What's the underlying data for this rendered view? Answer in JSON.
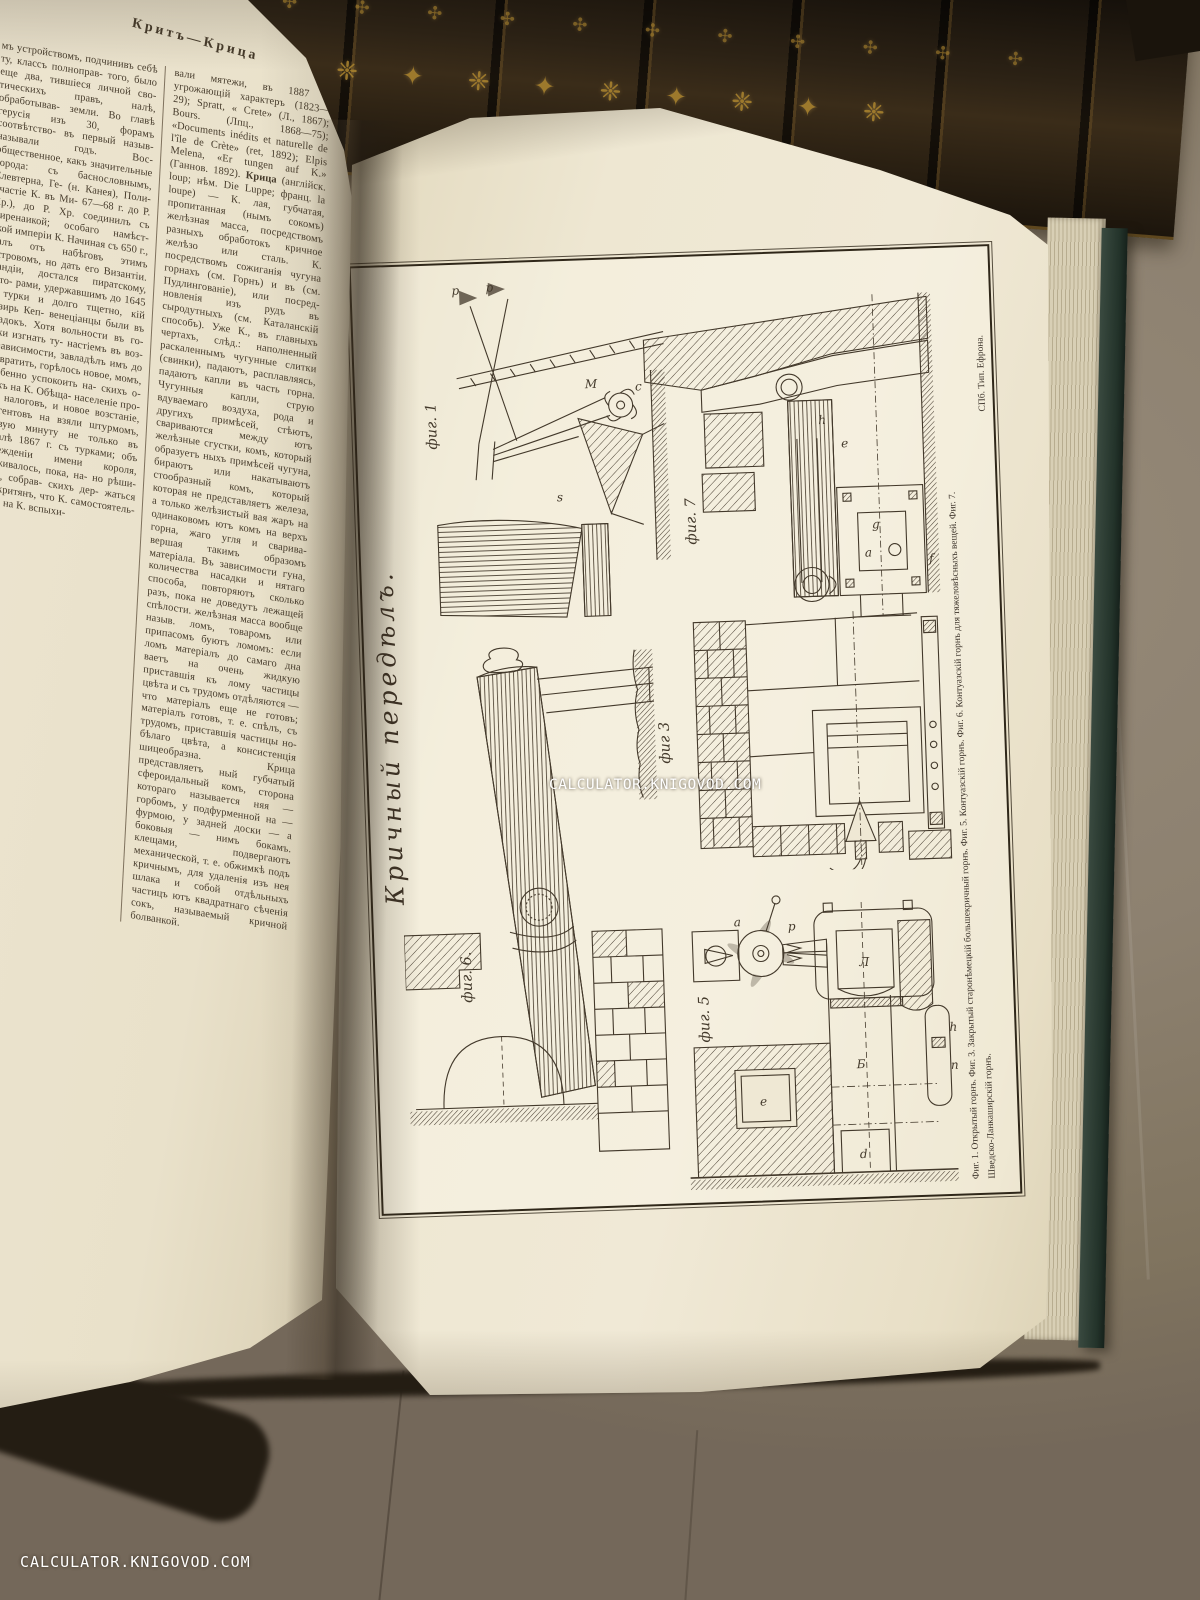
{
  "scene": {
    "watermark_text": "CALCULATOR.KNIGOVOD.COM",
    "spine_ornament": "❈ ✦ ❈ ✦ ❈ ✦ ❈ ✦ ❈ ✦ ❈",
    "spine_ornament_small": "✣ ✣ ✣ ✣ ✣ ✣ ✣ ✣ ✣ ✣ ✣ ✣"
  },
  "left_page": {
    "running_head": "Критъ—Крица",
    "column1": "мъ устройствомъ, подчинивъ себѣ ту, классъ полноправ- того, было еще два, тившіеся личной сво- тическихъ правъ, налѣ, обработывав- земли. Во главѣ герусія изъ 30, форамъ соотвѣтство- въ первый назыв- называли годъ. Вос- общественное, какъ значительные города: съ баснословнымъ, Елевтерна, Ге- (н. Канея), Поли- участіе К. въ Ми- 67—68 г. до Р. Хр.), до Р. Хр. соединилъ съ Киренаикой; особаго намѣст- ской имперіи К. Начиная съ 650 г., палъ отъ набѣговъ этимъ островомъ, но дать его Византіи. Кандіи, достался пиратскому, кото- рами, удержавшимъ до 1645 г. турки и долго тщетно, кій визирь Кеп- венеціанцы были въ упадокъ. Хотя вольности въ го- роки изгнать ту- настіемъ въ воз- независимости, завладѣлъ имъ до возвратить, горѣлось новое, момъ, особенно успокоить на- скихъ о-въ къ на К. Обѣща- населеніе про- отъ налоговъ, и новое возстаніе, сургентовъ на взяли штурмомъ, первую минуту не только въ началѣ 1867 г. съ турками; объ учрежденіи имени короля, держивалось, пока, на- но рѣши- лись, собрав- скихъ дер- жаться отъ критянъ, что К. самостоятель- наго, на К. вспыхи-",
    "column2_intro": "вали мятежи, въ 1887 и угрожающій характеръ (1823—29); Spratt, « Crete» (Л., 1867); Bours. (Лпц., 1868—75); «Documents inédits et naturelle de l'île de Crète» (ret, 1892); Elpis Melena, «Er tungen auf K.» (Ганнов. 1892). ",
    "column2_headword": "Крица",
    "column2_body": " (англійск. loup; нѣм. Die Luppe; франц. la loupe) — К. лая, губчатая, пропитанная (нымъ сокомъ) желѣзная масса, посредствомъ разныхъ обработокъ кричное желѣзо или сталь. К. посредствомъ сожиганія чугуна горнахъ (см. Горнъ) и въ (см. Пудлингованіе), или посред- новленія изъ рудъ въ сыродутныхъ (см. Каталанскій способъ). Уже К., въ главныхъ чертахъ, слѣд.: наполненный раскаленнымъ чугунные слитки (свинки), падаютъ, расплавляясь, падаютъ капли въ часть горна. Чугунныя капли, струю вдуваемаго воздуха, рода и другихъ примѣсей, стѣютъ, свариваются между ютъ желѣзные сгустки, комъ, который образуетъ ныхъ примѣсей чугуна, бираютъ или накатываютъ стообразный комъ, который которая не представляетъ железа, а только желѣзистый вая жаръ на одинаковомъ ютъ комъ на верхъ горна, жаго угля и сварива- вершая такимъ образомъ матеріала. Въ зависимости гуна, количества насадки и нятаго способа, повторяютъ сколько разъ, пока не доведутъ лежащей спѣлости. желѣзная масса вообще назыв. ломъ, товаромъ или припасомъ буютъ ломомъ: если ломъ матеріалъ до самаго дна ваетъ на очень жидкую приставшія къ лому частицы цвѣта и съ трудомъ отдѣляются — что матеріалъ еще не готовъ; матеріалъ готовъ, т. е. спѣлъ, съ трудомъ, приставшія частицы но-бѣлаго цвѣта, а консистенція шицеобразна. Крица представляетъ ный губчатый сфероидальный комъ, сторона котораго называется няя — горбомъ, у подфурменной на — фурмою, у задней доски — а боковыя — нимъ бокамъ. клещами, подвергаютъ механической, т. е. обжимкѣ подъ кричнымъ, для удаленія изъ нея шлака и собой отдѣльныхъ частицъ ютъ квадратнаго сѣченія сокъ, называемый кричной болванкой."
  },
  "plate": {
    "script_title": "Кричный передѣлъ.",
    "labels": {
      "fig1": "фиг. 1",
      "fig3": "фиг 3",
      "fig5": "фиг. 5",
      "fig6": "фиг. 6.",
      "fig7": "фиг. 7"
    },
    "caption_line1": "Фиг. 1. Открытый горнъ.  Фиг. 3. Закрытый старонѣмецкій большекричный горнъ.  Фиг. 5. Контуазскій горнъ.  Фиг. 6. Контуазскій горнъ для тяжеловѣсныхъ вещей.  Фиг. 7.",
    "caption_line2": "Шведско-Ланкаширскій горнъ.",
    "imprint": "СПб. Тип. Ефрона.",
    "fig1_letters": [
      "p",
      "p",
      "M",
      "c",
      "s"
    ],
    "fig7_letters": [
      "e",
      "a",
      "g",
      "h",
      "f"
    ],
    "fig5_letters": [
      "a",
      "p",
      "Л",
      "Б",
      "d",
      "e",
      "h",
      "n"
    ]
  }
}
